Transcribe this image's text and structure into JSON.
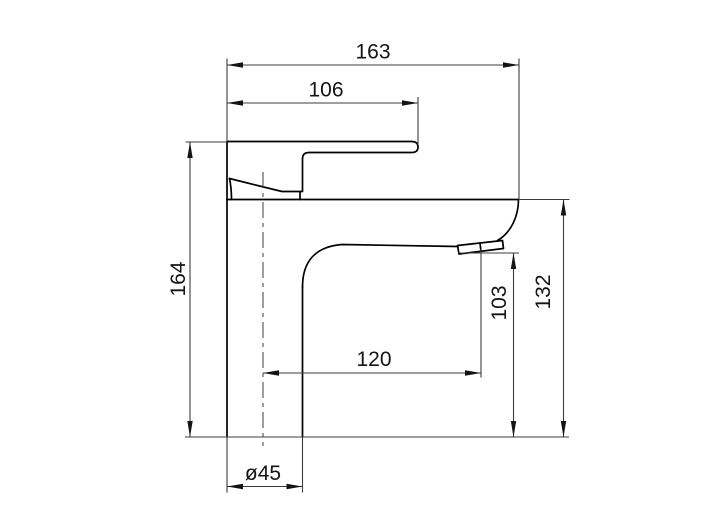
{
  "drawing": {
    "kind": "technical-dimension-drawing",
    "subject": "single-lever basin mixer faucet, side elevation",
    "dimensions": {
      "total_projection": "163",
      "lever_projection": "106",
      "total_height": "164",
      "spout_top_height": "132",
      "outlet_height": "103",
      "spout_reach": "120",
      "base_diameter": "ø45"
    },
    "colors": {
      "background": "#ffffff",
      "outline": "#000000",
      "dimension_lines": "#3c3c3c",
      "text": "#141414"
    }
  }
}
